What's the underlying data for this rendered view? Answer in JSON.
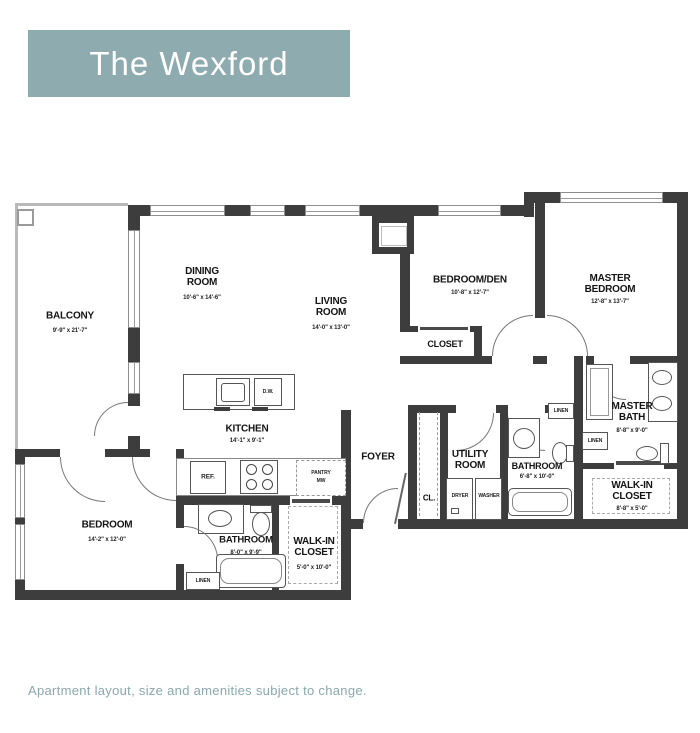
{
  "header": {
    "title": "The Wexford"
  },
  "footer": {
    "disclaimer": "Apartment layout, size and amenities subject to change."
  },
  "colors": {
    "accent": "#8EABB0",
    "wall": "#3d3d3d"
  },
  "floorplan": {
    "rooms": {
      "balcony": {
        "name": "BALCONY",
        "dims": "9'-9\" x 21'-7\""
      },
      "dining": {
        "name": "DINING ROOM",
        "dims": "10'-6\" x 14'-6\""
      },
      "living": {
        "name": "LIVING ROOM",
        "dims": "14'-0\" x 13'-0\""
      },
      "bedroom_den": {
        "name": "BEDROOM/DEN",
        "dims": "10'-8\" x 12'-7\""
      },
      "master_bedroom": {
        "name": "MASTER BEDROOM",
        "dims": "12'-8\" x 13'-7\""
      },
      "den_closet": {
        "name": "CLOSET"
      },
      "kitchen": {
        "name": "KITCHEN",
        "dims": "14'-1\" x 9'-1\""
      },
      "foyer": {
        "name": "FOYER"
      },
      "entry_closet": {
        "name": "CL."
      },
      "utility": {
        "name": "UTILITY ROOM"
      },
      "bathroom_2": {
        "name": "BATHROOM",
        "dims": "6'-8\" x 10'-0\""
      },
      "master_bath": {
        "name": "MASTER BATH",
        "dims": "8'-8\" x 9'-0\""
      },
      "master_walk_in": {
        "name": "WALK-IN CLOSET",
        "dims": "8'-8\" x 5'-0\""
      },
      "bedroom_2": {
        "name": "BEDROOM",
        "dims": "14'-2\" x 12'-0\""
      },
      "bathroom_1": {
        "name": "BATHROOM",
        "dims": "8'-0\" x 9'-9\""
      },
      "walk_in_2": {
        "name": "WALK-IN CLOSET",
        "dims": "5'-0\" x 10'-0\""
      }
    },
    "fixtures": {
      "ref": "REF.",
      "dw": "D.W.",
      "pantry": "PANTRY",
      "mw": "MW",
      "dryer": "DRYER",
      "washer": "WASHER",
      "linen": "LINEN"
    }
  }
}
